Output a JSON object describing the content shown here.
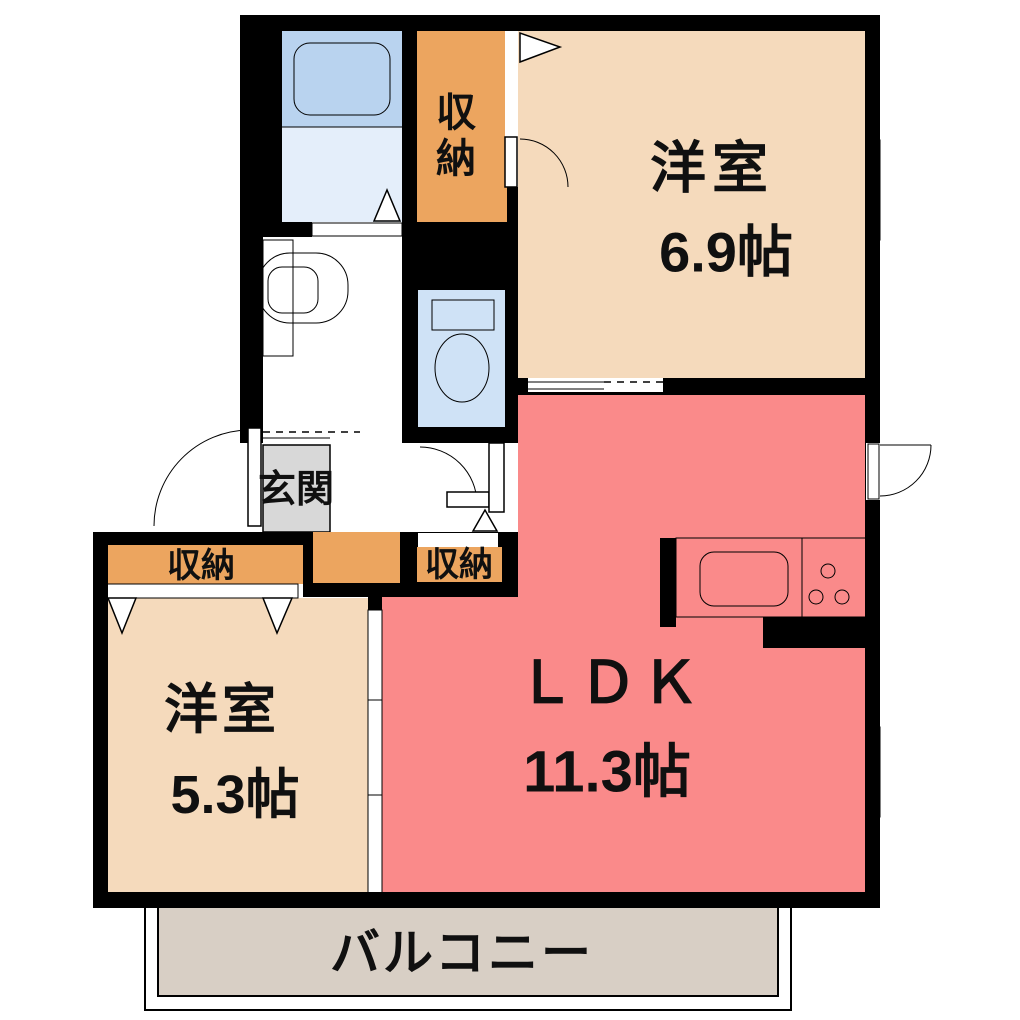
{
  "floorplan": {
    "rooms": {
      "western_room_east": {
        "label": "洋室",
        "size": "6.9帖"
      },
      "ldk": {
        "label": "ＬＤＫ",
        "size": "11.3帖"
      },
      "western_room_west": {
        "label": "洋室",
        "size": "5.3帖"
      },
      "entrance": {
        "label": "玄関"
      },
      "balcony": {
        "label": "バルコニー"
      },
      "closet_north": {
        "char_top": "収",
        "char_bottom": "納"
      },
      "closet_west": {
        "label": "収納"
      },
      "closet_hall": {
        "label": "収納"
      }
    },
    "colors": {
      "wall": "#000000",
      "room_beige": "#f5dabc",
      "ldk_pink": "#fa8a8a",
      "closet_orange": "#eca55f",
      "entrance_gray": "#d8d8d8",
      "balcony_gray": "#d8cfc5",
      "bath_upper_blue": "#b9d3ef",
      "bath_floor_blue": "#e4eefa",
      "fixture_cyan": "#b5ecf3",
      "basin_blue": "#bcd5f2",
      "toilet_room_blue": "#cfe2f6",
      "toilet_bowl_blue": "#aeccee",
      "toilet_tank_blue": "#c5daf3",
      "counter_blue": "#c8dcf5",
      "burner_brown": "#7a4a1e"
    }
  }
}
